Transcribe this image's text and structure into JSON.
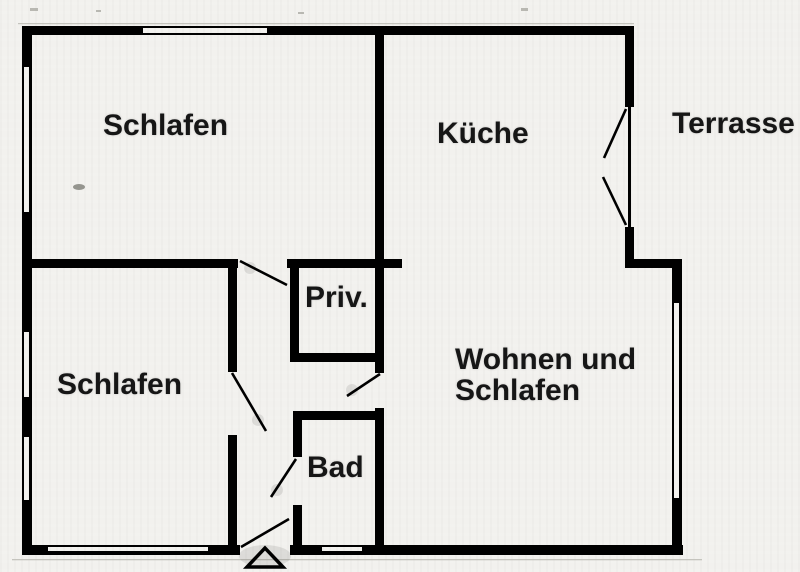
{
  "colors": {
    "wall": "#000000",
    "background": "#f2f1ee",
    "text": "#161616"
  },
  "rooms": {
    "schlafen_top": {
      "label": "Schlafen"
    },
    "kueche": {
      "label": "Küche"
    },
    "terrasse": {
      "label": "Terrasse"
    },
    "priv": {
      "label": "Priv."
    },
    "schlafen_left": {
      "label": "Schlafen"
    },
    "bad": {
      "label": "Bad"
    },
    "wohnen": {
      "label": "Wohnen und Schlafen"
    }
  }
}
